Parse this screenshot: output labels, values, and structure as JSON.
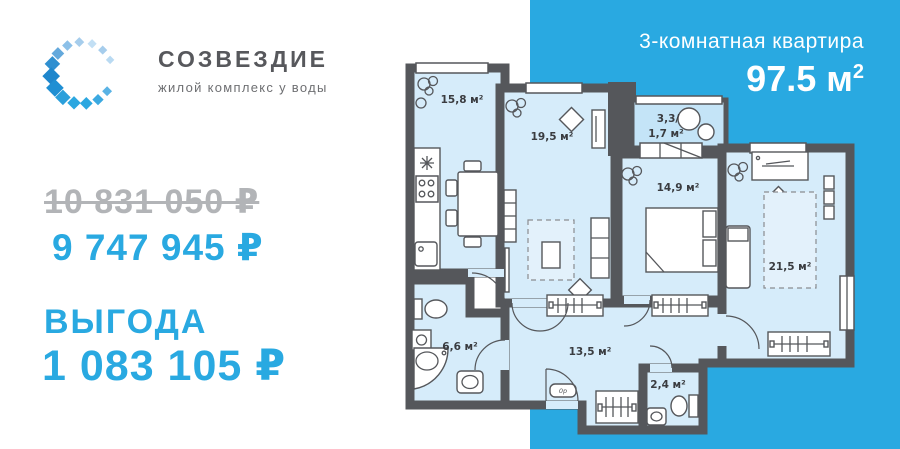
{
  "logo": {
    "title": "СОЗВЕЗДИЕ",
    "subtitle": "жилой комплекс у воды",
    "icon": "diamond-star-ring"
  },
  "pricing": {
    "old_price": "10 831 050 ₽",
    "new_price": "9 747 945 ₽",
    "benefit_label": "ВЫГОДА",
    "benefit_value": "1 083 105 ₽"
  },
  "apartment": {
    "type_label": "3-комнатная квартира",
    "area_main": "97.5 м",
    "area_sup": "2"
  },
  "floorplan": {
    "rooms": {
      "kitchen": "15,8 м²",
      "living": "19,5 м²",
      "balcony_line1": "3,3/",
      "balcony_line2": "1,7 м²",
      "bedroom1": "14,9 м²",
      "bedroom2": "21,5 м²",
      "bathroom": "6,6 м²",
      "hallway": "13,5 м²",
      "wc": "2,4 м²"
    },
    "shoe_cabinet": "0р"
  },
  "colors": {
    "accent_blue": "#29A9E1",
    "wall_gray": "#55575B",
    "room_fill": "#D6ECFA",
    "balcony_fill": "#C4E4F7",
    "old_price_gray": "#B2B4B7",
    "logo_gray": "#57585C"
  }
}
